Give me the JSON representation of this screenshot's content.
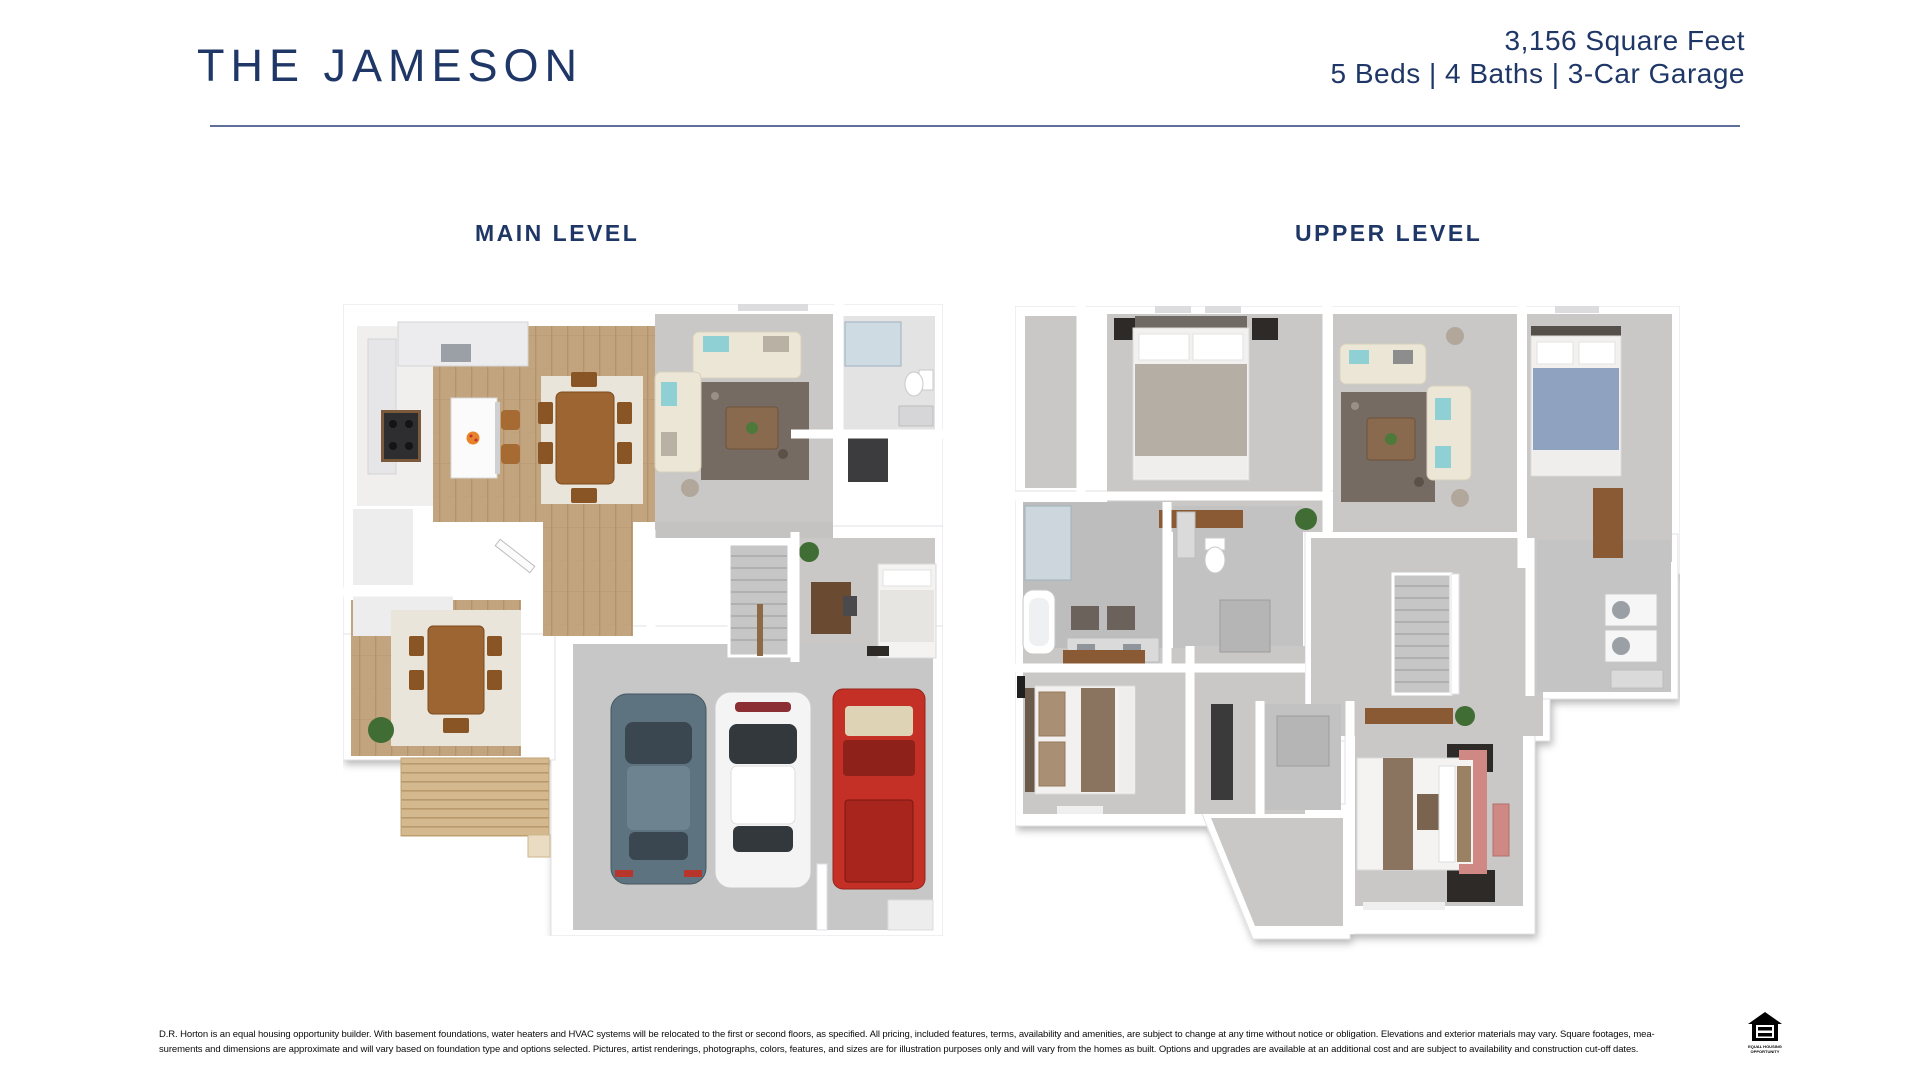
{
  "header": {
    "title": "THE JAMESON",
    "square_feet": "3,156 Square Feet",
    "specs": "5 Beds | 4 Baths | 3-Car Garage"
  },
  "floorplans": {
    "main": {
      "label": "MAIN LEVEL"
    },
    "upper": {
      "label": "UPPER LEVEL"
    }
  },
  "footer": {
    "disclaimer_line1": "D.R. Horton is an equal housing opportunity builder. With basement foundations, water heaters and HVAC systems will be relocated to the first or second floors, as specified. All pricing, included features, terms, availability and amenities, are subject to change at any time without notice or obligation. Elevations and exterior materials may vary. Square footages, mea-",
    "disclaimer_line2": "surements and dimensions are approximate and will vary based on foundation type and options selected. Pictures, artist renderings, photographs, colors, features, and sizes are for illustration purposes only and will vary from the homes as built. Options and upgrades are available at an additional cost and are subject to availability and construction cut-off dates.",
    "equal_housing_line1": "EQUAL HOUSING",
    "equal_housing_line2": "OPPORTUNITY"
  },
  "colors": {
    "navy": "#1f3767",
    "divider": "#5f6f99",
    "wood": "#c2a47f",
    "deck": "#d3b98d",
    "carpet": "#c9c8c6",
    "garage": "#c7c7c7",
    "rug_dark": "#766b62",
    "rug_cream": "#e9e5da",
    "sofa": "#ece6d6",
    "teal": "#8fd0d4",
    "tablewood": "#9c6531",
    "car_blue": "#5d7380",
    "car_white": "#f4f4f4",
    "car_red": "#c43026",
    "bed_gray": "#b5aea4",
    "bed_blue": "#8fa3c0",
    "bed_tan": "#8a7460",
    "pink": "#cf8884"
  }
}
